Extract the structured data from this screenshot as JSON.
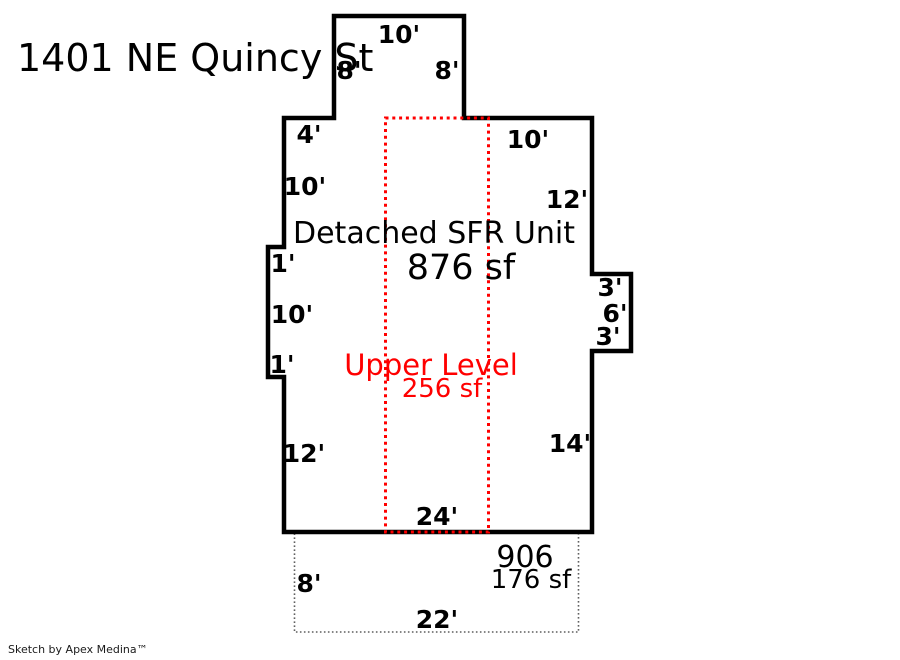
{
  "title": "1401 NE Quincy St",
  "footer": "Sketch by Apex Medina™",
  "colors": {
    "main_outline": "#000000",
    "upper_level_outline": "#ff0000",
    "lower_level_outline": "#5f5f5f",
    "text": "#000000"
  },
  "main_unit": {
    "label": "Detached SFR Unit",
    "area": "876 sf"
  },
  "upper_level": {
    "label": "Upper Level",
    "area": "256 sf"
  },
  "lower_level": {
    "number": "906",
    "area": "176 sf"
  },
  "dimensions": {
    "top_bump_width": "10'",
    "top_bump_left_side": "8'",
    "top_bump_right_side": "8'",
    "top_edge_left": "4'",
    "left_edge_upper": "10'",
    "top_edge_right": "10'",
    "right_edge_upper": "12'",
    "left_notch_top": "1'",
    "left_notch_side": "10'",
    "left_notch_bottom": "1'",
    "left_edge_lower": "12'",
    "right_bump_top": "3'",
    "right_bump_side": "6'",
    "right_bump_bottom": "3'",
    "right_edge_lower": "14'",
    "bottom_edge": "24'",
    "lower_level_left_side": "8'",
    "lower_level_bottom": "22'"
  }
}
